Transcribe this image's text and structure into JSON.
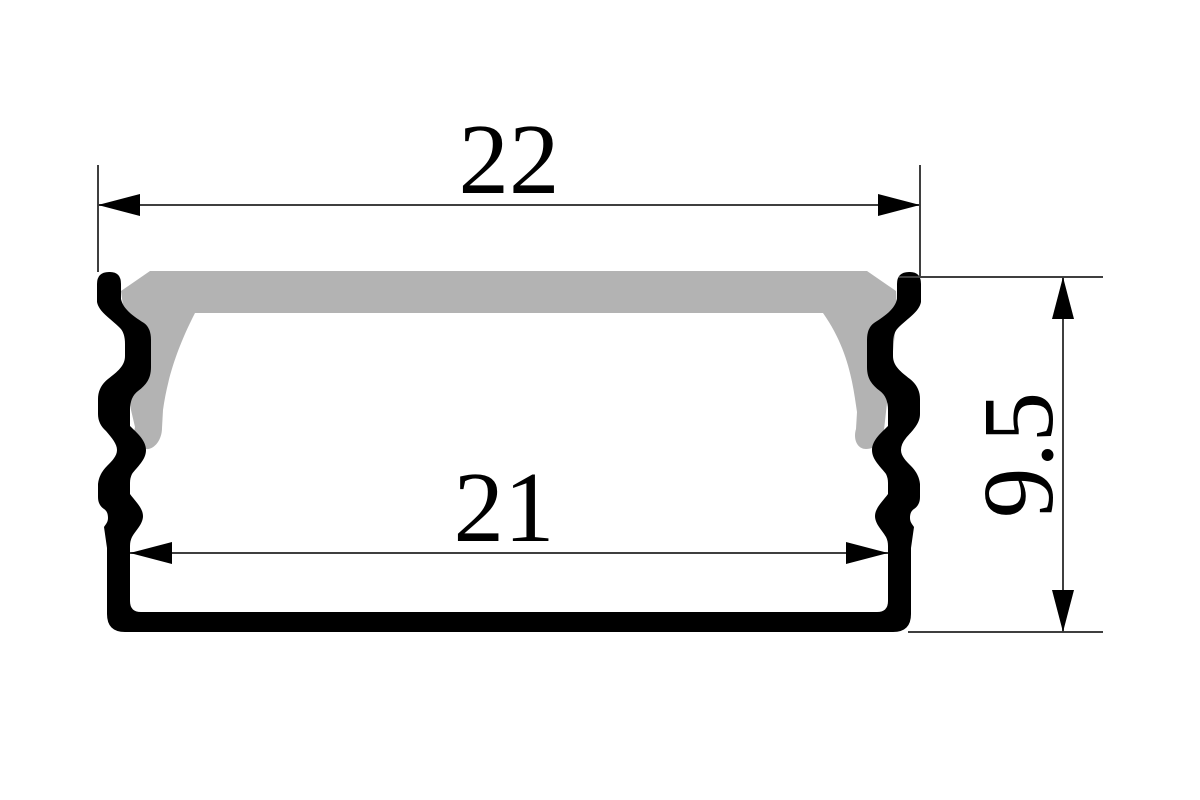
{
  "drawing": {
    "title": "profile-cross-section",
    "dimensions": {
      "outer_width": "22",
      "inner_width": "21",
      "height": "9.5"
    },
    "colors": {
      "background": "#ffffff",
      "profile": "#000000",
      "diffuser_cover": "#b3b3b3",
      "dimension_line": "#3f3f3f",
      "label_text": "#000000"
    }
  }
}
